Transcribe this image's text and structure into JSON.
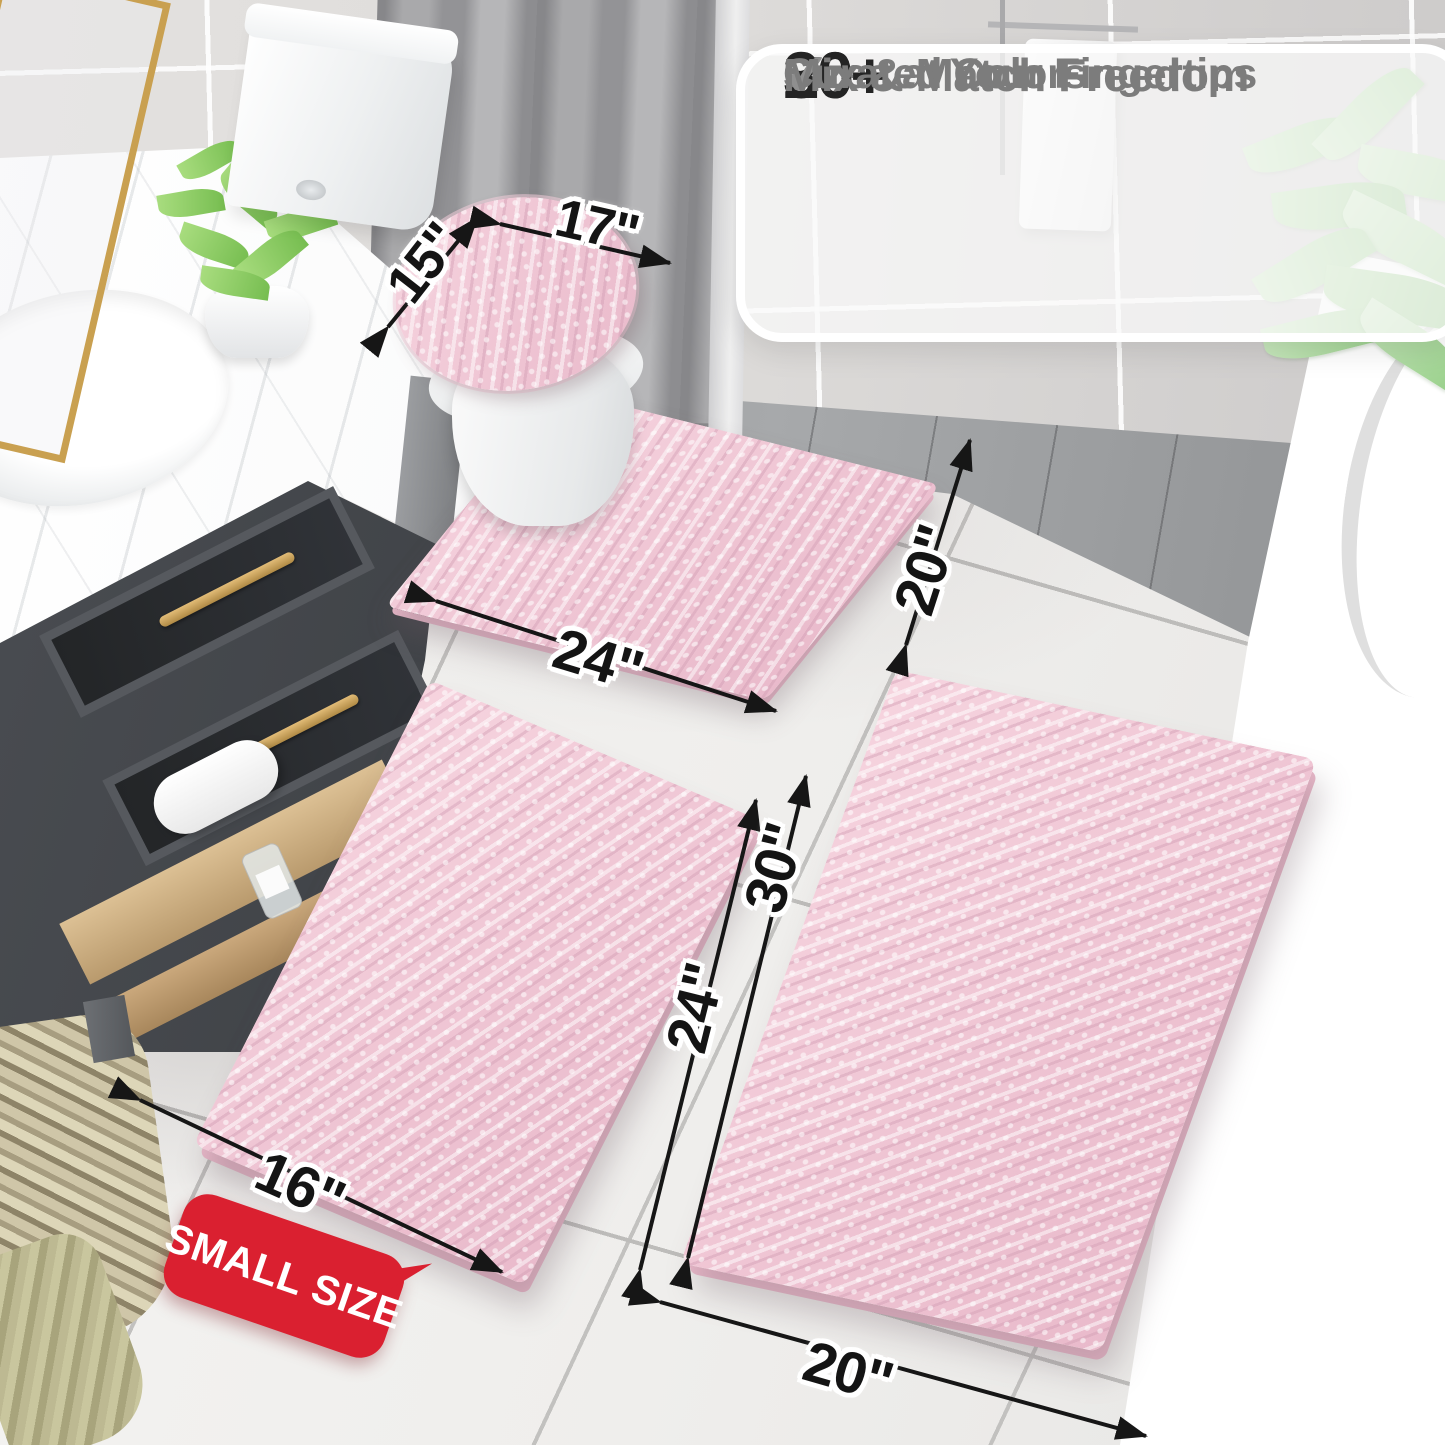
{
  "callout": {
    "check_glyph": "✔",
    "rows": [
      {
        "icon": "check-icon",
        "value": "20+",
        "label": "Sizes at Your Fingertips"
      },
      {
        "icon": "check-icon",
        "value": "30+",
        "label": "Curated Colors"
      },
      {
        "icon": "check-icon",
        "value": "",
        "label": "Mix & Match Freedom"
      }
    ]
  },
  "dimensions": {
    "lid_depth": "15\"",
    "lid_width": "17\"",
    "contour_width": "24\"",
    "contour_depth": "20\"",
    "small_mat_length": "24\"",
    "small_mat_width": "16\"",
    "large_mat_length": "30\"",
    "large_mat_width": "20\""
  },
  "badge": {
    "text": "SMALL SIZE"
  },
  "colors": {
    "mat_pink": "#f2c9d6",
    "badge_red": "#da2030",
    "arrow_black": "#161616",
    "callout_number": "#242424",
    "callout_label": "#7c7c7c",
    "check_gray": "#8f8f8f"
  }
}
